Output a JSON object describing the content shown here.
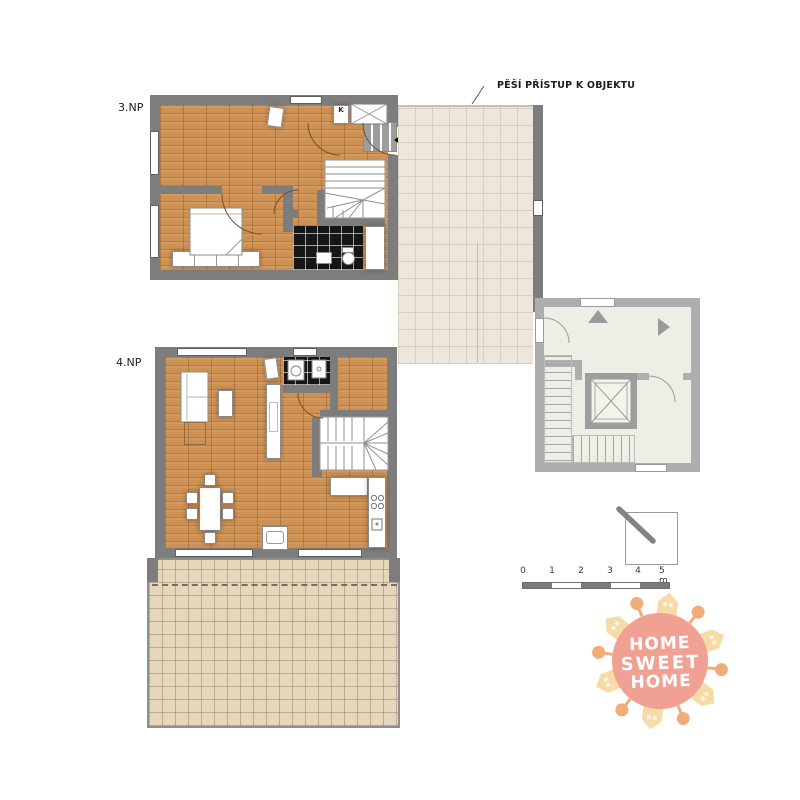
{
  "labels": {
    "floor3": "3.NP",
    "floor4": "4.NP",
    "access_route": "PĚŠÍ PŘÍSTUP K OBJEKTU",
    "boiler": "K"
  },
  "scalebar": {
    "ticks": [
      "0",
      "1",
      "2",
      "3",
      "4",
      "5 m"
    ]
  },
  "logo": {
    "line1": "HOME",
    "line2": "SWEET",
    "line3": "HOME"
  },
  "colors": {
    "wall": "#7d7d7d",
    "core_wall": "#aeaeae",
    "wood_floor": "#cd9154",
    "bathroom_tile": "#161616",
    "walkway": "#ece6dc",
    "terrace": "#e5d7bc",
    "core_floor": "#edefe7",
    "logo_pink": "#f19a8c",
    "logo_yellow": "#f7d9a1",
    "logo_orange": "#f0a66e"
  }
}
